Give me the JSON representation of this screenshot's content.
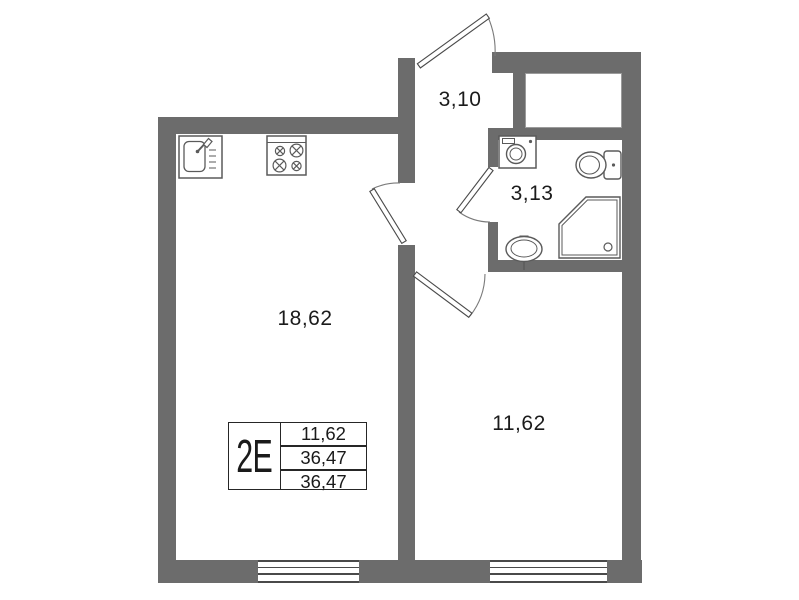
{
  "colors": {
    "wall": "#6c6c6c",
    "fixture_line": "#5a5a5a",
    "text": "#1b1b1b"
  },
  "rooms": {
    "hallway": {
      "area": "3,10"
    },
    "bathroom": {
      "area": "3,13"
    },
    "living_kitchen": {
      "area": "18,62"
    },
    "bedroom": {
      "area": "11,62"
    }
  },
  "info_box": {
    "flat_type": "2E",
    "rows": {
      "row1": "11,62",
      "row2": "36,47",
      "row3": "36,47"
    }
  },
  "fixtures": [
    "kitchen-sink-icon",
    "stove-icon",
    "washing-machine-icon",
    "toilet-icon",
    "shower-icon",
    "wash-basin-icon"
  ],
  "doors": [
    "entry-door",
    "living-room-door",
    "bathroom-door",
    "bedroom-door"
  ]
}
